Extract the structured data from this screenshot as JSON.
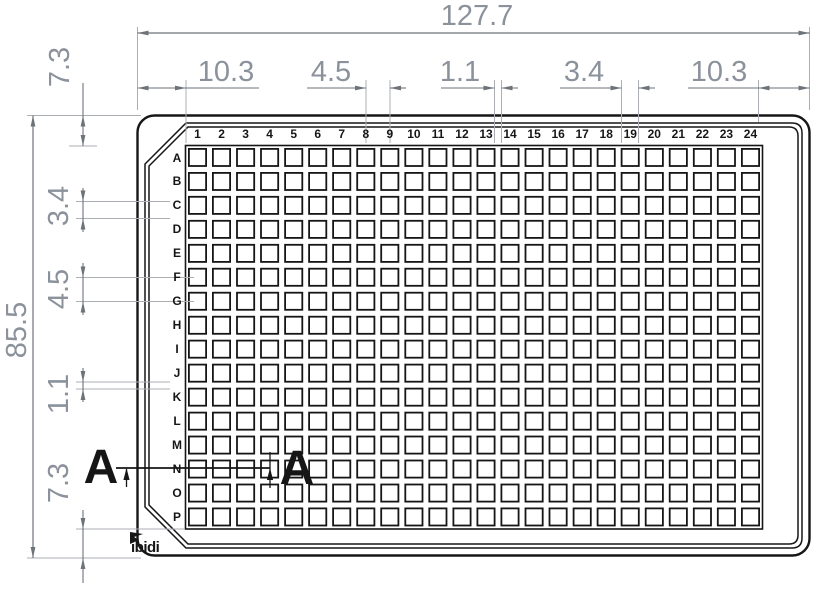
{
  "drawing": {
    "subject": "384-well microplate dimensional drawing, top view",
    "section_label_left": "A",
    "section_label_right": "A",
    "logo_text": "ibidi"
  },
  "dimensions": {
    "overall_width": "127.7",
    "overall_height": "85.5",
    "top": [
      "10.3",
      "4.5",
      "1.1",
      "3.4",
      "10.3"
    ],
    "left": [
      "7.3",
      "3.4",
      "4.5",
      "1.1",
      "7.3"
    ]
  },
  "plate": {
    "column_labels": [
      "1",
      "2",
      "3",
      "4",
      "5",
      "6",
      "7",
      "8",
      "9",
      "10",
      "11",
      "12",
      "13",
      "14",
      "15",
      "16",
      "17",
      "18",
      "19",
      "20",
      "21",
      "22",
      "23",
      "24"
    ],
    "row_labels": [
      "A",
      "B",
      "C",
      "D",
      "E",
      "F",
      "G",
      "H",
      "I",
      "J",
      "K",
      "L",
      "M",
      "N",
      "O",
      "P"
    ]
  },
  "colors": {
    "outline": "#161616",
    "dim_line": "#6d7379",
    "witness": "#abafb4",
    "dim_text": "#8b929c",
    "label_text": "#161616"
  }
}
